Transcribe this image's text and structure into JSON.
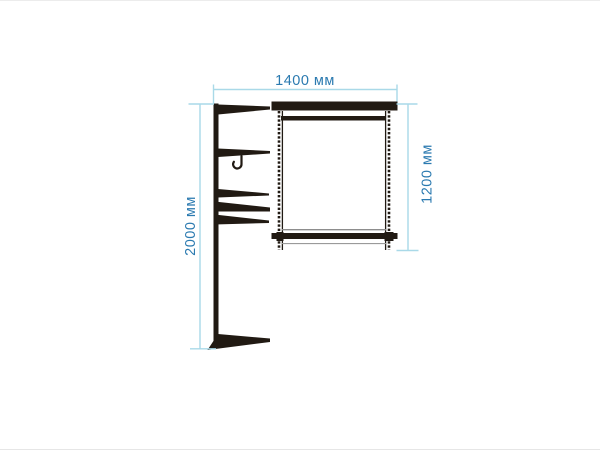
{
  "colors": {
    "background": "#ffffff",
    "structure": "#211a13",
    "dimension_line": "#a9d9e8",
    "dimension_text": "#2b7ab0"
  },
  "dimensions": {
    "width_label": "1400 мм",
    "total_height_label": "2000 мм",
    "frame_height_label": "1200 мм"
  }
}
